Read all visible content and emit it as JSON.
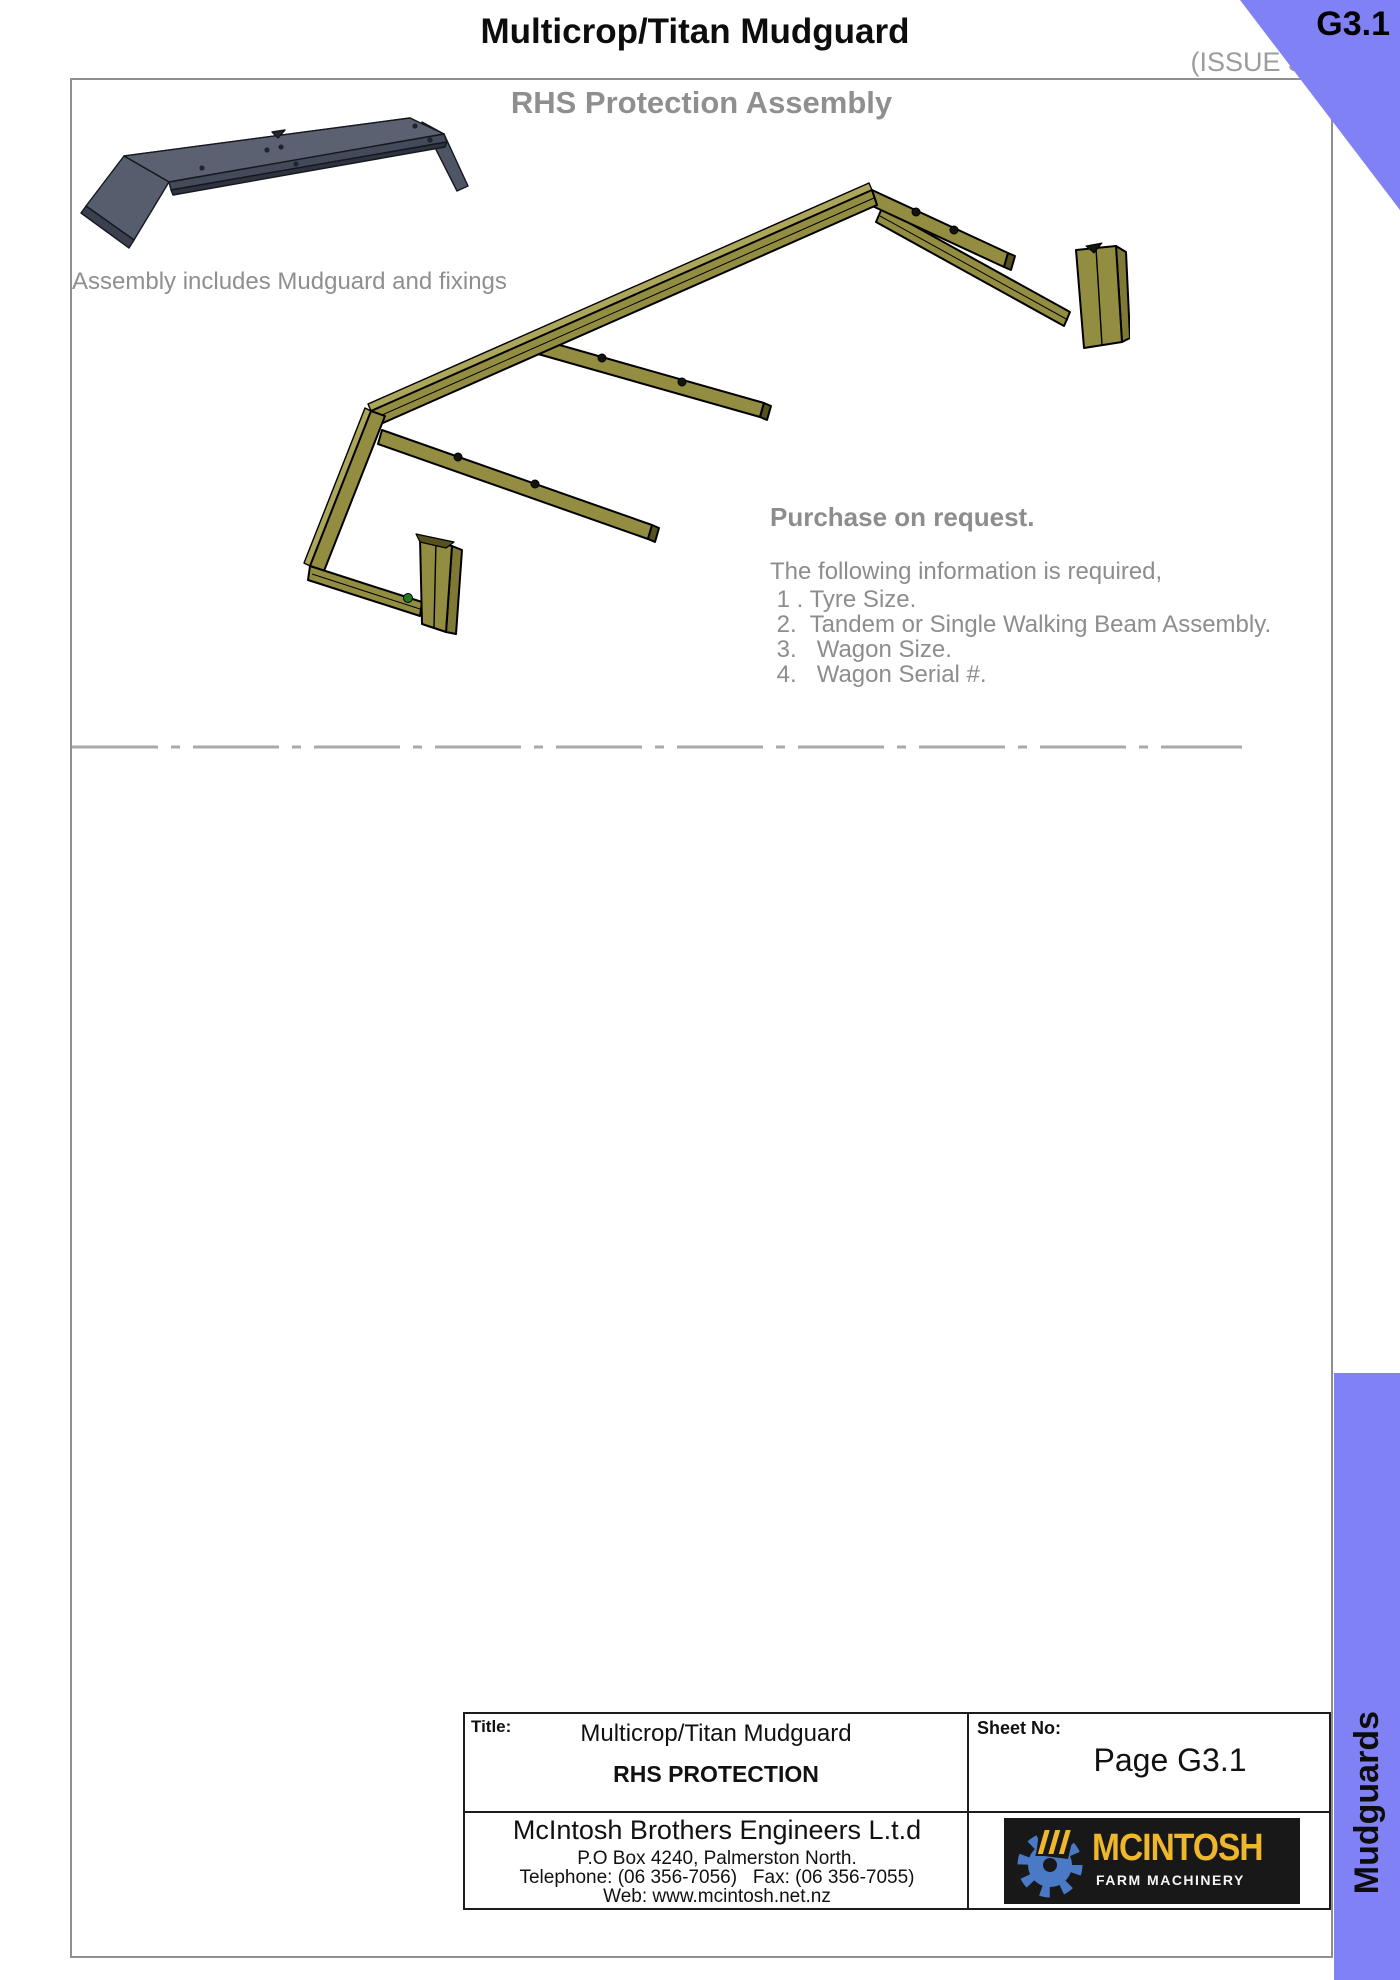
{
  "page": {
    "title": "Multicrop/Titan Mudguard",
    "issue": "(ISSUE 3)",
    "corner_tab": "G3.1",
    "sidebar_label": "Mudguards"
  },
  "drawing": {
    "heading": "RHS Protection Assembly",
    "note": "Assembly includes Mudguard and fixings",
    "purchase_heading": "Purchase on request.",
    "info_intro": "The following information is required,",
    "info_items": [
      " 1 . Tyre Size.",
      " 2.  Tandem or Single Walking Beam Assembly.",
      " 3.   Wagon Size.",
      " 4.   Wagon Serial #."
    ]
  },
  "title_block": {
    "title_label": "Title:",
    "title_value": "Multicrop/Titan Mudguard",
    "subtitle": "RHS PROTECTION",
    "sheet_label": "Sheet No:",
    "sheet_value": "Page G3.1",
    "company": "McIntosh Brothers Engineers L.t.d",
    "address": "P.O Box 4240, Palmerston North.",
    "phone_fax": "Telephone: (06 356-7056)   Fax: (06 356-7055)",
    "web": "Web: www.mcintosh.net.nz"
  },
  "logo": {
    "name": "MCINTOSH",
    "tagline": "FARM MACHINERY"
  },
  "colors": {
    "accent_purple": "#8181f6",
    "frame_olive": "#938d41",
    "frame_olive_light": "#aca65a",
    "mudguard_gray": "#5b6171",
    "text_gray": "#8d8d8d",
    "logo_yellow": "#efb72b",
    "logo_blue": "#4a79c5",
    "logo_background": "#181818"
  }
}
